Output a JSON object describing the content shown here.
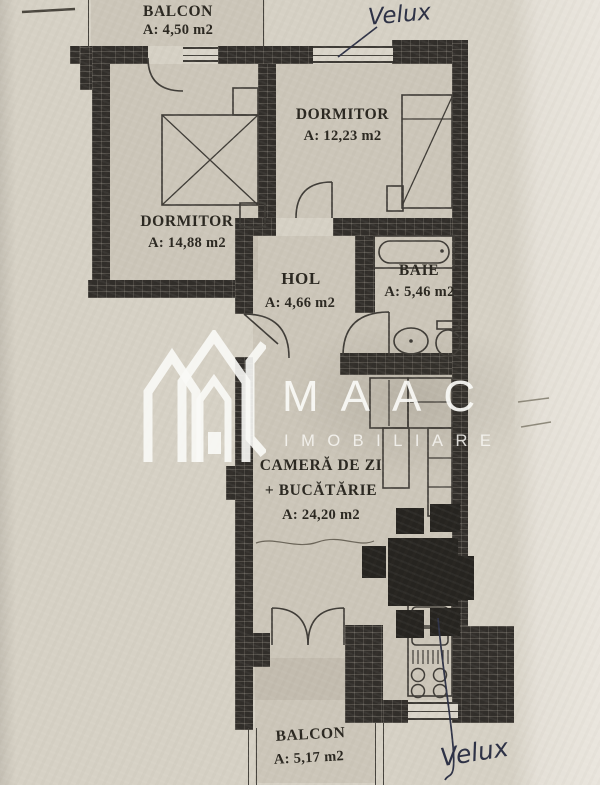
{
  "floorplan": {
    "rooms": {
      "balcony_top": {
        "name": "BALCON",
        "area": "A: 4,50 m2"
      },
      "bedroom_right": {
        "name": "DORMITOR",
        "area": "A: 12,23 m2"
      },
      "bedroom_left": {
        "name": "DORMITOR",
        "area": "A: 14,88 m2"
      },
      "hall": {
        "name": "HOL",
        "area": "A: 4,66 m2"
      },
      "bathroom": {
        "name": "BAIE",
        "area": "A: 5,46 m2"
      },
      "living_kitchen": {
        "line1": "CAMERĂ DE ZI",
        "line2": "+ BUCĂTĂRIE",
        "area": "A: 24,20 m2"
      },
      "balcony_bottom": {
        "name": "BALCON",
        "area": "A: 5,17 m2"
      }
    },
    "handwritten_notes": {
      "top": "Velux",
      "bottom": "Velux"
    },
    "watermark": {
      "brand": "MAAC",
      "tagline": "IMOBILIARE"
    },
    "colors": {
      "paper": "#d6d1c5",
      "wall": "#312e2a",
      "line": "#3e3b36",
      "ink": "#2e3246",
      "label": "#29261f",
      "watermark": "#faf9f5"
    }
  }
}
